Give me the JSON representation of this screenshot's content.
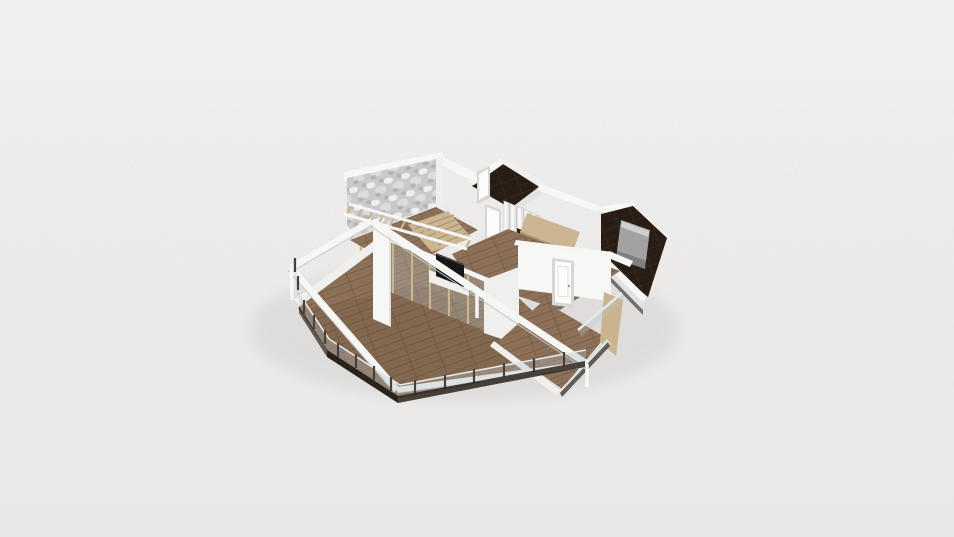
{
  "app": {
    "name": "3d-floorplan-viewer",
    "view": "perspective-3d-render",
    "visible_text": ""
  },
  "scene": {
    "type": "3d-floorplan-render",
    "background": "light-gray-ground-with-fine-grid",
    "rooms": [
      {
        "name": "terrace",
        "floor": "wood-deck",
        "features": [
          "glass-railing",
          "dark-posts",
          "white-pergola-beams",
          "wood-slat-canopy",
          "dark-base-fascia"
        ]
      },
      {
        "name": "living-room",
        "floor": "wood-plank",
        "features": [
          "tv-panel",
          "media-cabinet",
          "glass-partition-with-wood-mullions"
        ]
      },
      {
        "name": "stair-hall",
        "floor": "wood-plank",
        "features": [
          "marble-accent-wall",
          "light-wood-stairs",
          "wood-slat-wall"
        ]
      },
      {
        "name": "bathroom",
        "floor": "dark-tile",
        "features": [
          "white-door"
        ]
      },
      {
        "name": "wardrobe",
        "floor": "wood-plank",
        "features": [
          "sliding-doors",
          "open-shelves"
        ]
      },
      {
        "name": "hallway",
        "floor": "wood-plank",
        "features": [
          "white-back-door",
          "wood-cabinet",
          "light-wood-platform"
        ]
      },
      {
        "name": "bedroom",
        "floor": "dark-tile",
        "features": [
          "gray-bed",
          "door-jamb"
        ]
      },
      {
        "name": "garden-room",
        "floor": "wood-plank",
        "features": [
          "white-door",
          "glass-panel",
          "wood-interior-wall"
        ]
      }
    ]
  },
  "palette": {
    "bgTop": "#f1f0f0",
    "bgMid": "#ecebea",
    "bgBot": "#e9e8e7",
    "gridLine": "#d9d9d7",
    "shadow": "#000000",
    "woodBase": "#8d7158",
    "woodLine": "#7a5f48",
    "woodDark": "#6d543f",
    "deckTint": "rgba(62,41,22,0.10)",
    "darkFloor": "#281d14",
    "darkFloorLine": "#3a2a1c",
    "wallWhite": "#f7f7f6",
    "wallLight": "#efefee",
    "wallShade": "#e2e2e1",
    "wallDim": "#cfcfce",
    "beam": "#f6f6f5",
    "beamEdge": "#c9c9c8",
    "marbleBase": "#c9c9c9",
    "marbleLight": "#eeeeee",
    "marbleMid": "#dcdcdc",
    "marbleDark": "#9f9f9f",
    "tanWood": "#c9b48e",
    "tanWoodDark": "#b09672",
    "stairTread": "#cbb592",
    "stairLine": "#a8916c",
    "glass": "rgba(185,198,205,0.30)",
    "glassRail": "rgba(175,188,196,0.35)",
    "railTop": "#e8e8e7",
    "postDark": "#46413c",
    "baseShadow": "#2a231c",
    "bedGray": "#a2a2a2",
    "bedGrayLight": "#d0d0d0",
    "bedGrayDark": "#808080",
    "tvBlack": "#161616",
    "doorWhite": "#fcfcfb",
    "doorFrame": "#d6d6d5",
    "knob": "#9a9a9a",
    "closetBase": "#e8e8e7",
    "closetLight": "#fbfbfa",
    "closetDark": "#c9c9c8",
    "shelfDark": "#2e2317"
  }
}
